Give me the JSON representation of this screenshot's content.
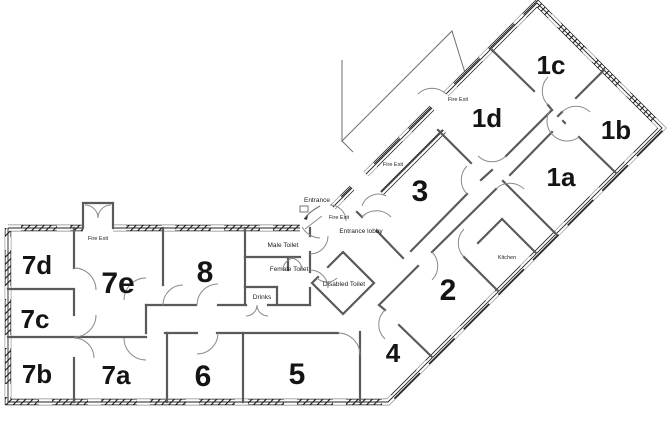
{
  "meta": {
    "description": "Office building floor plan with two wings (one horizontal, one at 45 degrees) showing numbered lettable rooms and facilities",
    "colors": {
      "background": "#ffffff",
      "wall_interior": "#5a5a5a",
      "wall_exterior_hatch": "#111111",
      "text": "#141414"
    }
  },
  "rooms": {
    "r7d": {
      "label": "7d"
    },
    "r7e": {
      "label": "7e"
    },
    "r8": {
      "label": "8"
    },
    "r7c": {
      "label": "7c"
    },
    "r7b": {
      "label": "7b"
    },
    "r7a": {
      "label": "7a"
    },
    "r6": {
      "label": "6"
    },
    "r5": {
      "label": "5"
    },
    "r4": {
      "label": "4"
    },
    "r3": {
      "label": "3"
    },
    "r2": {
      "label": "2"
    },
    "r1d": {
      "label": "1d"
    },
    "r1c": {
      "label": "1c"
    },
    "r1b": {
      "label": "1b"
    },
    "r1a": {
      "label": "1a"
    }
  },
  "labels": {
    "fire_exit_vestibule": {
      "text": "Fire Exit"
    },
    "male_toilet": {
      "text": "Male Toilet"
    },
    "female_toilet": {
      "text": "Female Toilet"
    },
    "drinks": {
      "text": "Drinks"
    },
    "disabled_toilet": {
      "text": "Disabled Toilet"
    },
    "entrance_lobby": {
      "text": "Entrance lobby"
    },
    "entrance": {
      "text": "Entrance"
    },
    "fire_exit_entrance": {
      "text": "Fire Exit"
    },
    "fire_exit_mid": {
      "text": "Fire Exit"
    },
    "fire_exit_upper": {
      "text": "Fire Exit"
    },
    "kitchen": {
      "text": "Kitchen"
    }
  }
}
